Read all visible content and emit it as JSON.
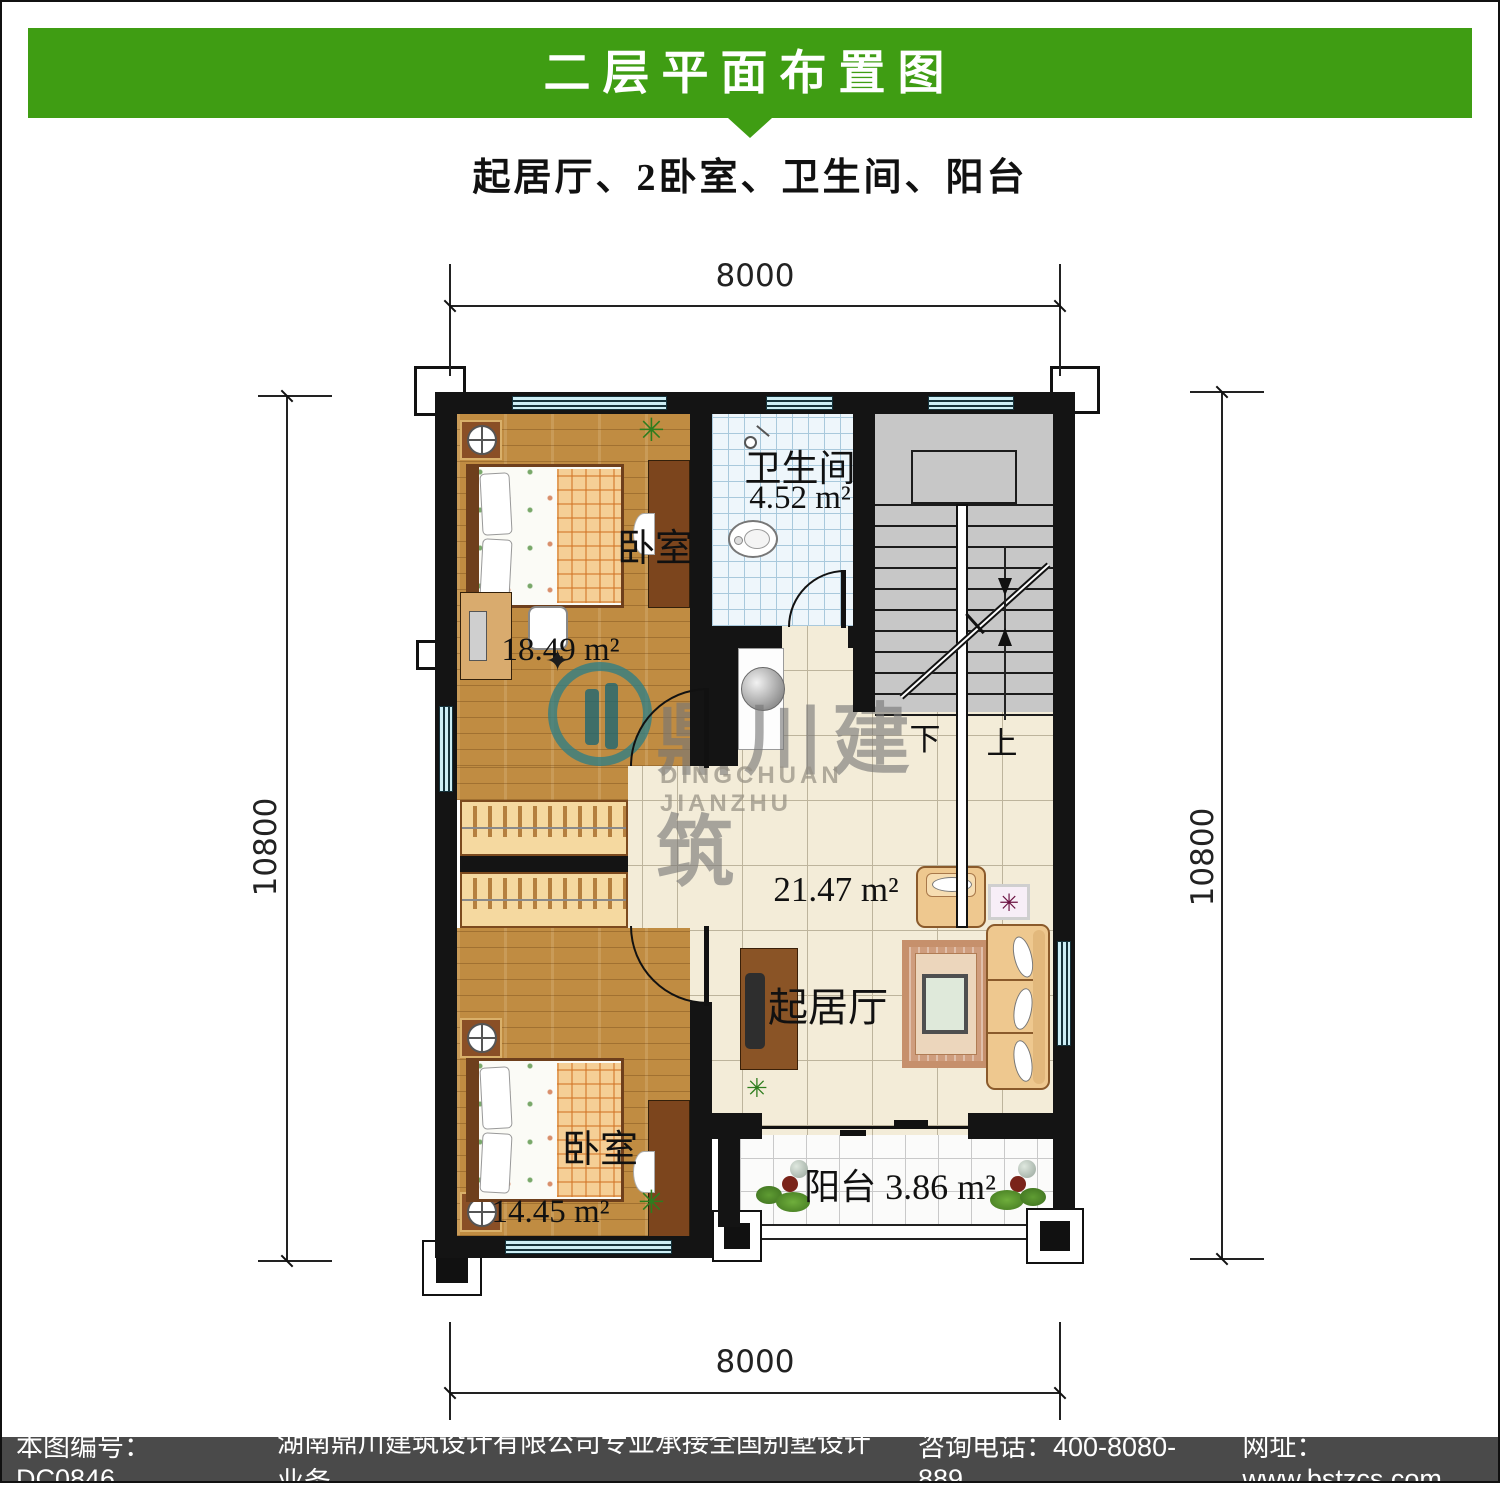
{
  "header": {
    "title": "二层平面布置图",
    "subtitle": "起居厅、2卧室、卫生间、阳台"
  },
  "dimensions": {
    "top": "8000",
    "bottom": "8000",
    "left": "10800",
    "right": "10800"
  },
  "rooms": {
    "bedroom_top": {
      "name": "卧室",
      "area": "18.49 m²"
    },
    "bedroom_bottom": {
      "name": "卧室",
      "area": "14.45 m²"
    },
    "bathroom": {
      "name": "卫生间",
      "area": "4.52 m²"
    },
    "living": {
      "name": "起居厅",
      "area": "21.47 m²"
    },
    "balcony": {
      "name": "阳台",
      "area": "3.86 m²"
    }
  },
  "stairs": {
    "down": "下",
    "up": "上"
  },
  "watermark": {
    "cn": "鼎川建筑",
    "en": "DINGCHUAN JIANZHU",
    "sparkle": "✦"
  },
  "icons": {
    "plant": "✳",
    "flower": "✳"
  },
  "footer": {
    "part1": "本图编号：DC0846",
    "part2": "湖南鼎川建筑设计有限公司专业承接全国别墅设计业务",
    "part3": "咨询电话：400-8080-889",
    "part4": "网址：www.bstzcs.com"
  },
  "colors": {
    "banner_green": "#3f9d13",
    "footer_gray": "#4a4a4a",
    "wall_black": "#141414",
    "wood_floor": "#c08c42",
    "living_tile": "#f3ecd8",
    "bath_tile": "#eef6fb",
    "stair_gray": "#c7c7c7",
    "window_cyan": "#cdeef5",
    "watermark_teal": "#2a7d87"
  }
}
